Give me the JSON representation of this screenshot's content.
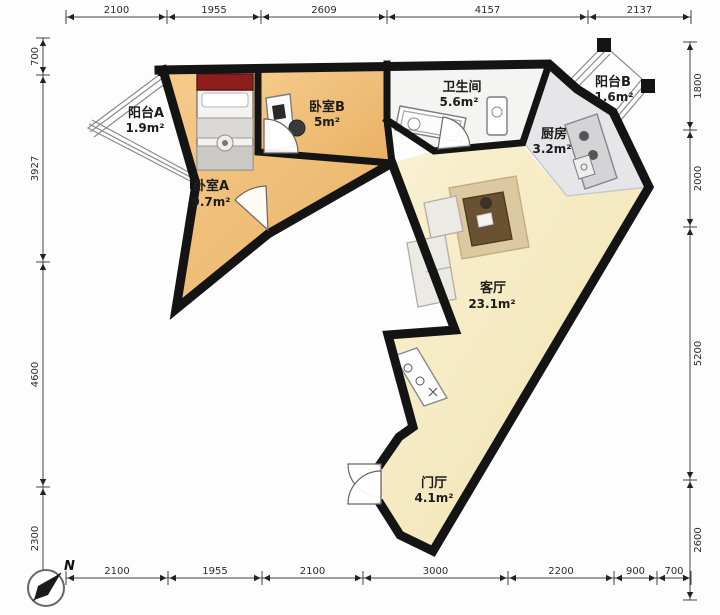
{
  "compass": {
    "label": "N"
  },
  "rooms": [
    {
      "id": "balcony-a",
      "name": "阳台A",
      "area": "1.9m²"
    },
    {
      "id": "bedroom-a",
      "name": "卧室A",
      "area": "9.7m²"
    },
    {
      "id": "bedroom-b",
      "name": "卧室B",
      "area": "5m²"
    },
    {
      "id": "bathroom",
      "name": "卫生间",
      "area": "5.6m²"
    },
    {
      "id": "balcony-b",
      "name": "阳台B",
      "area": "1.6m²"
    },
    {
      "id": "kitchen",
      "name": "厨房",
      "area": "3.2m²"
    },
    {
      "id": "living",
      "name": "客厅",
      "area": "23.1m²"
    },
    {
      "id": "entry",
      "name": "门厅",
      "area": "4.1m²"
    }
  ],
  "dimensions": {
    "top": [
      "2100",
      "1955",
      "2609",
      "4157",
      "2137"
    ],
    "bottom": [
      "2100",
      "1955",
      "2100",
      "3000",
      "2200",
      "900",
      "700"
    ],
    "left": [
      "700",
      "3927",
      "4600",
      "2300"
    ],
    "right": [
      "1800",
      "2000",
      "5200",
      "2600"
    ]
  },
  "colors": {
    "wall": "#141414",
    "wood_floor": "#efbf7c",
    "living_floor": "#f6edc9",
    "tile_floor": "#f4f4f2",
    "kitchen_floor": "#e6e6e8",
    "bed_headboard": "#8e1e1e",
    "rug": "#dcc9a2"
  }
}
